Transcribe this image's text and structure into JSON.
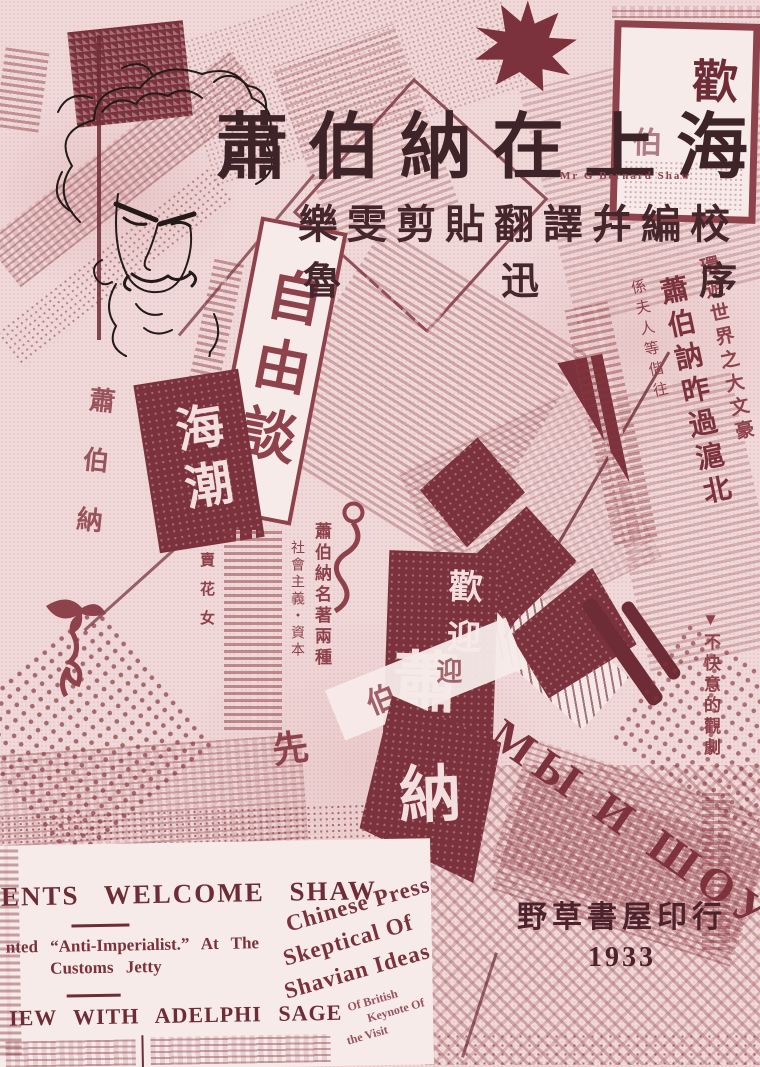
{
  "palette": {
    "paper": "#f0d9d9",
    "ink": "#8e424b",
    "ink_dark": "#7b323c",
    "ink_deep": "#56262e",
    "title_ink": "#3e2428",
    "sketch_ink": "#241a17"
  },
  "masthead": {
    "title": "蕭伯納在上海",
    "subtitle": "樂雯剪貼翻譯幷編校",
    "preface": {
      "c1": "魯",
      "c2": "迅",
      "c3": "序"
    },
    "english_caption": "Mr G Bernard Shaw"
  },
  "imprint": {
    "publisher": "野草書屋印行",
    "year": "1933"
  },
  "banners": {
    "free_talk": "自由談",
    "sea_tide": "海潮",
    "left_strip": "蕭伯納",
    "welcome": "歡迎",
    "welcome_shaw": "蕭",
    "bo": "伯",
    "na": "納",
    "ying": "迎",
    "xian": "先",
    "top_right_big": "歡",
    "top_right_small": "伯"
  },
  "right_news": {
    "col1": "環遊世界之大文豪",
    "col2": "蕭伯訥昨過滬北",
    "col3": "係夫人等偕往",
    "side_note": "▼不快意的觀劇"
  },
  "book_ad": {
    "line1": "蕭伯納名著兩種",
    "line2": "社會主義・資本",
    "line3": "賣花女"
  },
  "russian_headline": "МЫ И ШОУ",
  "english_clipping": {
    "headline1": "ENTS WELCOME SHAW",
    "line2a": "nted “Anti-Imperialist.” At The",
    "line2b": "Customs Jetty",
    "headline3": "IEW WITH ADELPHI SAGE"
  },
  "press_clipping": {
    "l1": "Chinese Press",
    "l2": "Skeptical Of",
    "l3": "Shavian Ideas",
    "s1": "Of British",
    "s2": "Keynote Of",
    "s3": "the Visit"
  }
}
